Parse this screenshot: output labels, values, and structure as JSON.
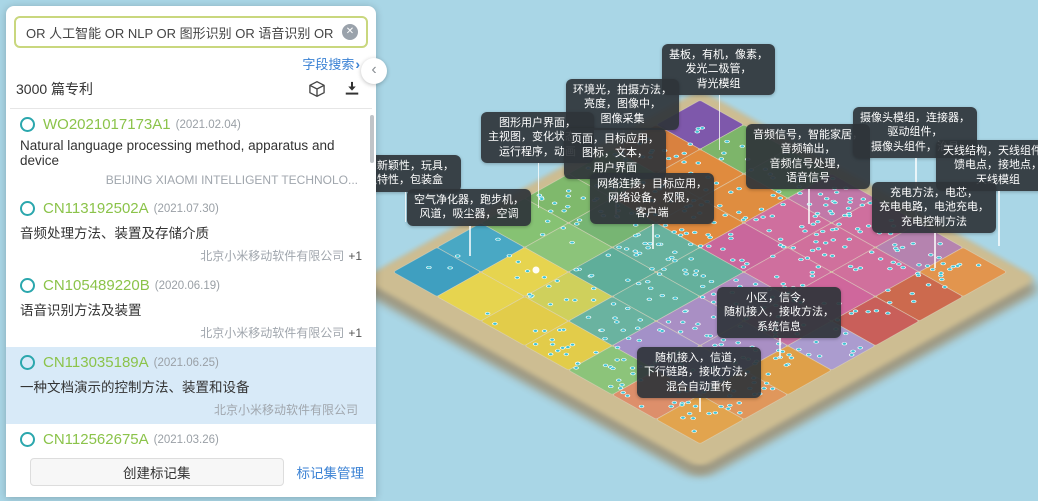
{
  "panel": {
    "search": {
      "value": "OR 人工智能 OR NLP OR 图形识别 OR 语音识别 OR 自然",
      "clear_icon": "✕"
    },
    "field_search_label": "字段搜索",
    "field_search_chevron": "›",
    "result_count": "3000 篇专利",
    "collapse_chevron": "‹",
    "patents": [
      {
        "id": "WO2021017173A1",
        "date": "(2021.02.04)",
        "title": "Natural language processing method, apparatus and device",
        "assignee": "BEIJING XIAOMI INTELLIGENT TECHNOLO...",
        "extra": ""
      },
      {
        "id": "CN113192502A",
        "date": "(2021.07.30)",
        "title": "音频处理方法、装置及存储介质",
        "assignee": "北京小米移动软件有限公司",
        "extra": "+1"
      },
      {
        "id": "CN105489220B",
        "date": "(2020.06.19)",
        "title": "语音识别方法及装置",
        "assignee": "北京小米移动软件有限公司",
        "extra": "+1"
      },
      {
        "id": "CN113035189A",
        "date": "(2021.06.25)",
        "title": "一种文档演示的控制方法、装置和设备",
        "assignee": "北京小米移动软件有限公司",
        "extra": ""
      },
      {
        "id": "CN112562675A",
        "date": "(2021.03.26)",
        "title": "语音信息处理方法、装置及存储介质",
        "assignee": "北京小米移动软件有限公司",
        "extra": ""
      }
    ],
    "create_tagset_button": "创建标记集",
    "manage_tagset_link": "标记集管理"
  },
  "map": {
    "labels": [
      {
        "name": "substrate-oled",
        "lines": [
          "基板，有机，像素，",
          "发光二极管，",
          "背光模组"
        ]
      },
      {
        "name": "ambient-light",
        "lines": [
          "环境光，拍摄方法，",
          "亮度，图像中，",
          "图像采集"
        ]
      },
      {
        "name": "gui-view",
        "lines": [
          "图形用户界面，",
          "主视图，变化状态，",
          "运行程序，动画"
        ]
      },
      {
        "name": "page-app",
        "lines": [
          "页面，目标应用，",
          "图标，文本，",
          "用户界面"
        ]
      },
      {
        "name": "audio-signal",
        "lines": [
          "音频信号，智能家居，",
          "音频输出，",
          "音频信号处理，",
          "语音信号"
        ]
      },
      {
        "name": "camera-module",
        "lines": [
          "摄像头模组，连接器，",
          "驱动组件，",
          "摄像头组件，治具"
        ]
      },
      {
        "name": "antenna",
        "lines": [
          "天线结构，天线组件，",
          "馈电点，接地点，",
          "天线模组"
        ]
      },
      {
        "name": "charging",
        "lines": [
          "充电方法，电芯，",
          "充电电路，电池充电，",
          "充电控制方法"
        ]
      },
      {
        "name": "network-connection",
        "lines": [
          "网络连接，目标应用，",
          "网络设备，权限，",
          "客户端"
        ]
      },
      {
        "name": "air-purifier",
        "lines": [
          "空气净化器，跑步机，",
          "风道，吸尘器，空调"
        ]
      },
      {
        "name": "novelty-toy",
        "lines": [
          "计，新颖性，玩具，",
          "独特性，包装盒"
        ]
      },
      {
        "name": "cell-signaling",
        "lines": [
          "小区，信令，",
          "随机接入，接收方法，",
          "系统信息"
        ]
      },
      {
        "name": "random-access",
        "lines": [
          "随机接入，信道，",
          "下行链路，接收方法，",
          "混合自动重传"
        ]
      }
    ],
    "colors": {
      "background": "#a9d6e6",
      "label_bg": "#2f343a",
      "dot": "#3ec3d4",
      "edge": "#c9b48a",
      "link_blue": "#3b82d4",
      "patent_green": "#8bc34a",
      "ring_teal": "#2ba7ad",
      "selected_row": "#d8eaf8",
      "input_border": "#c9d77e"
    },
    "grid_colors": [
      [
        "#7e58ab",
        "#7db56a",
        "#83bd6f",
        "#c178a8",
        "#cf6f9e",
        "#b583af",
        "#e2954e"
      ],
      [
        "#d9813f",
        "#e08b3e",
        "#df8d40",
        "#cf6f9e",
        "#d0709c",
        "#d0709c",
        "#cc6a4e"
      ],
      [
        "#7cb868",
        "#df8d40",
        "#e08b3e",
        "#c9679c",
        "#cf6f9e",
        "#cf679c",
        "#c95f5a"
      ],
      [
        "#7fb96c",
        "#77b573",
        "#68b29e",
        "#64b09c",
        "#b28cc0",
        "#c573a5",
        "#ab9ccf"
      ],
      [
        "#86c273",
        "#8cc47a",
        "#5fae9a",
        "#66b29e",
        "#a98fc4",
        "#a98fc4",
        "#dfa049"
      ],
      [
        "#49a8c4",
        "#e6d44f",
        "#cfd05c",
        "#6ab3a0",
        "#a391c8",
        "#a99bd0",
        "#e0975c"
      ],
      [
        "#3f9fc0",
        "#e6d44f",
        "#e2cc4a",
        "#e2cc4a",
        "#8cc47a",
        "#dd8f6b",
        "#e2a44e"
      ]
    ]
  }
}
